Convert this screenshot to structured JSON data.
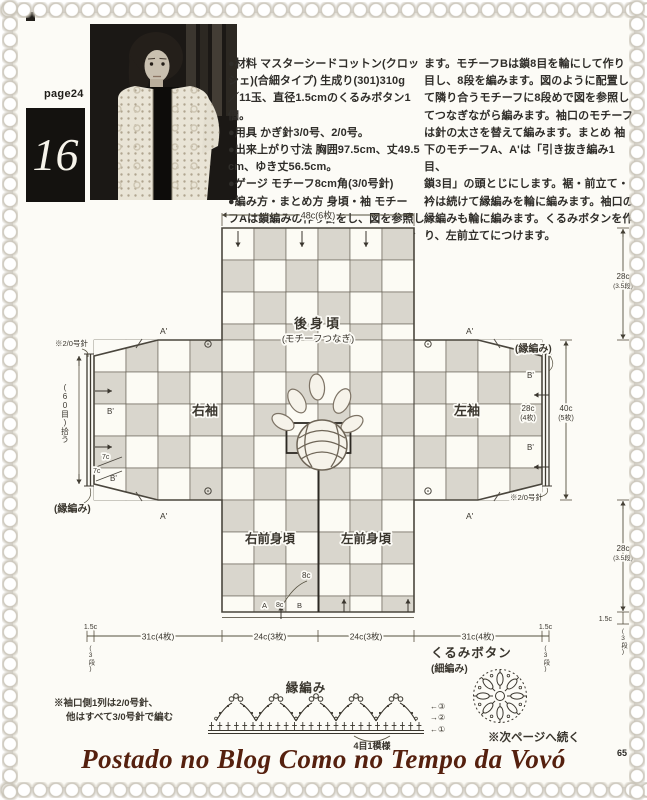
{
  "page": {
    "label": "page24",
    "number": "16",
    "folio": "65"
  },
  "instructions": {
    "col1": [
      "●材料 マスターシードコットン(クロッ",
      "シェ)(合細タイプ) 生成り(301)310g",
      "／11玉、直径1.5cmのくるみボタン1個。",
      "●用具 かぎ針3/0号、2/0号。",
      "●出来上がり寸法 胸囲97.5cm、丈49.5",
      "cm、ゆき丈56.5cm。",
      "●ゲージ モチーフ8cm角(3/0号針)",
      "●編み方・まとめ方 身頃・袖 モチー",
      "フAは鎖編みの作り目をし、図を参照し",
      "て11段編みます。必要枚数を編んでおき"
    ],
    "col2": [
      "ます。モチーフBは鎖8目を輪にして作り",
      "目し、8段を編みます。図のように配置し",
      "て隣り合うモチーフに8段めで図を参照し",
      "てつなぎながら編みます。袖口のモチーフ",
      "は針の太さを替えて編みます。まとめ 袖",
      "下のモチーフA、A'は「引き抜き編み1目、",
      "鎖3目」の頭とじにします。裾・前立て・",
      "衿は続けて縁編みを輪に編みます。袖口の",
      "縁編みも輪に編みます。くるみボタンを作",
      "り、左前立てにつけます。"
    ]
  },
  "diagram": {
    "dim_width_top": "48c(6枚)",
    "back_label": "後身頃",
    "back_sub": "(モチーフつなぎ)",
    "sleeve_right": "右袖",
    "sleeve_left": "左袖",
    "front_right": "右前身頃",
    "front_left": "左前身頃",
    "dim_28c": "28c",
    "dim_28c_sub": "(3.5段)",
    "dim_40c": "40c",
    "dim_40c_sub": "(5枚)",
    "dim_cuff": "28c",
    "dim_cuff_sub": "(4枚)",
    "dim_31c": "31c(4枚)",
    "dim_24c": "24c(3枚)",
    "dim_15c": "1.5c",
    "dim_3dan": "(3段)",
    "pickup": "(60目)拾う",
    "needle_note": "※2/0号針",
    "edge_note": "(縁編み)",
    "mark_a": "A'",
    "mark_b": "B'",
    "mark_7c": "7c",
    "neck_8c": "8c",
    "neck_a": "A",
    "neck_b": "B"
  },
  "edging": {
    "title": "縁編み",
    "repeat": "4目1模様",
    "row3": "←③",
    "row2": "→②",
    "row1": "←①"
  },
  "button": {
    "title": "くるみボタン",
    "sub": "(細編み)",
    "next_note": "※次ページへ続く"
  },
  "notes": {
    "line1": "※袖口側1列は2/0号針、",
    "line2": "他はすべて3/0号針で編む"
  },
  "footer": {
    "blog": "Postado no Blog Como no Tempo da Vovó"
  },
  "colors": {
    "checker_gray": "#d9d6cd",
    "paper": "#fcfbf6",
    "grid_line": "#6f6a5e",
    "outline": "#4a463d",
    "ink": "#3a362e",
    "blog_text": "#55200e"
  }
}
